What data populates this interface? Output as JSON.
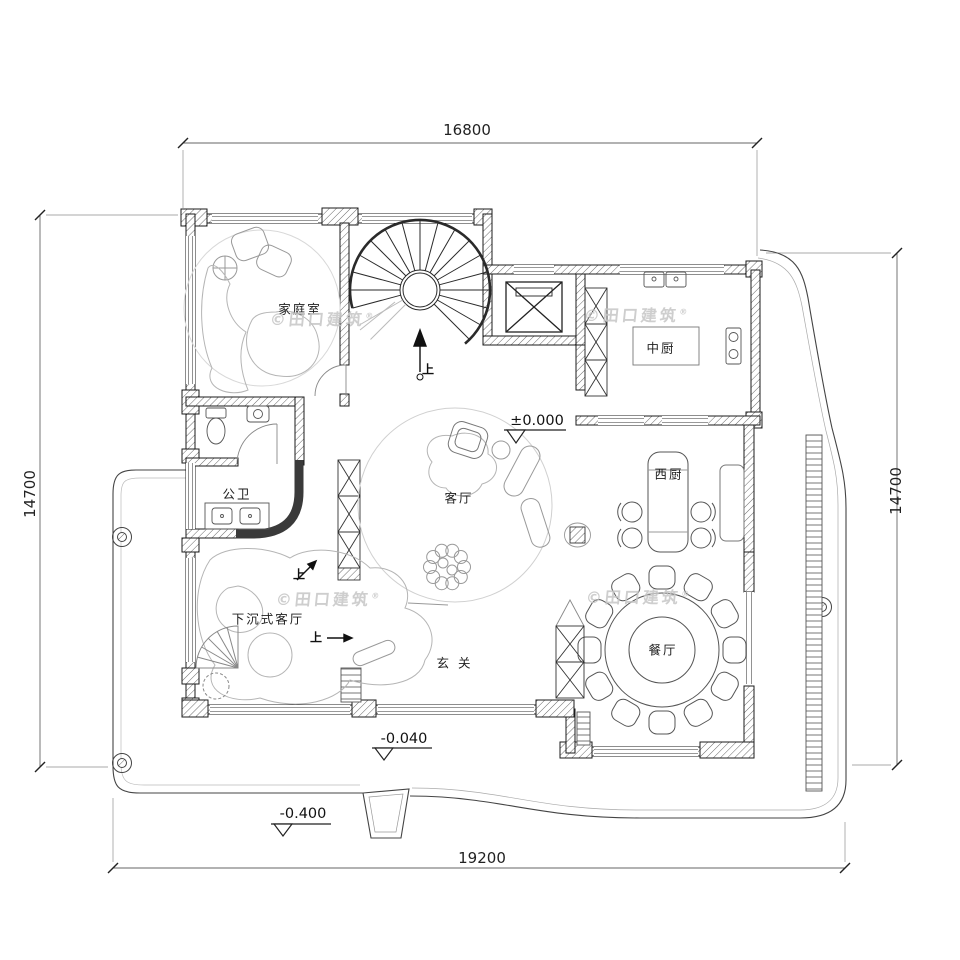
{
  "dimensions": {
    "top": "16800",
    "bottom": "19200",
    "left": "14700",
    "right": "14700"
  },
  "rooms": {
    "family_room": "家庭室",
    "public_bath": "公卫",
    "living_room": "客厅",
    "chinese_kitchen": "中厨",
    "western_kitchen": "西厨",
    "dining_room": "餐厅",
    "sunken_living_room": "下沉式客厅",
    "foyer": "玄关"
  },
  "levels": {
    "ground": "±0.000",
    "foyer": "-0.040",
    "outdoor": "-0.400"
  },
  "annotations": {
    "up": "上"
  },
  "watermark": {
    "text": "©田口建筑",
    "registered": "®"
  },
  "colors": {
    "wall_line": "#1b1b1b",
    "furniture_line": "#b5b5b5",
    "dimension_line": "#555555",
    "watermark": "#c6c6c6",
    "background": "#ffffff"
  }
}
